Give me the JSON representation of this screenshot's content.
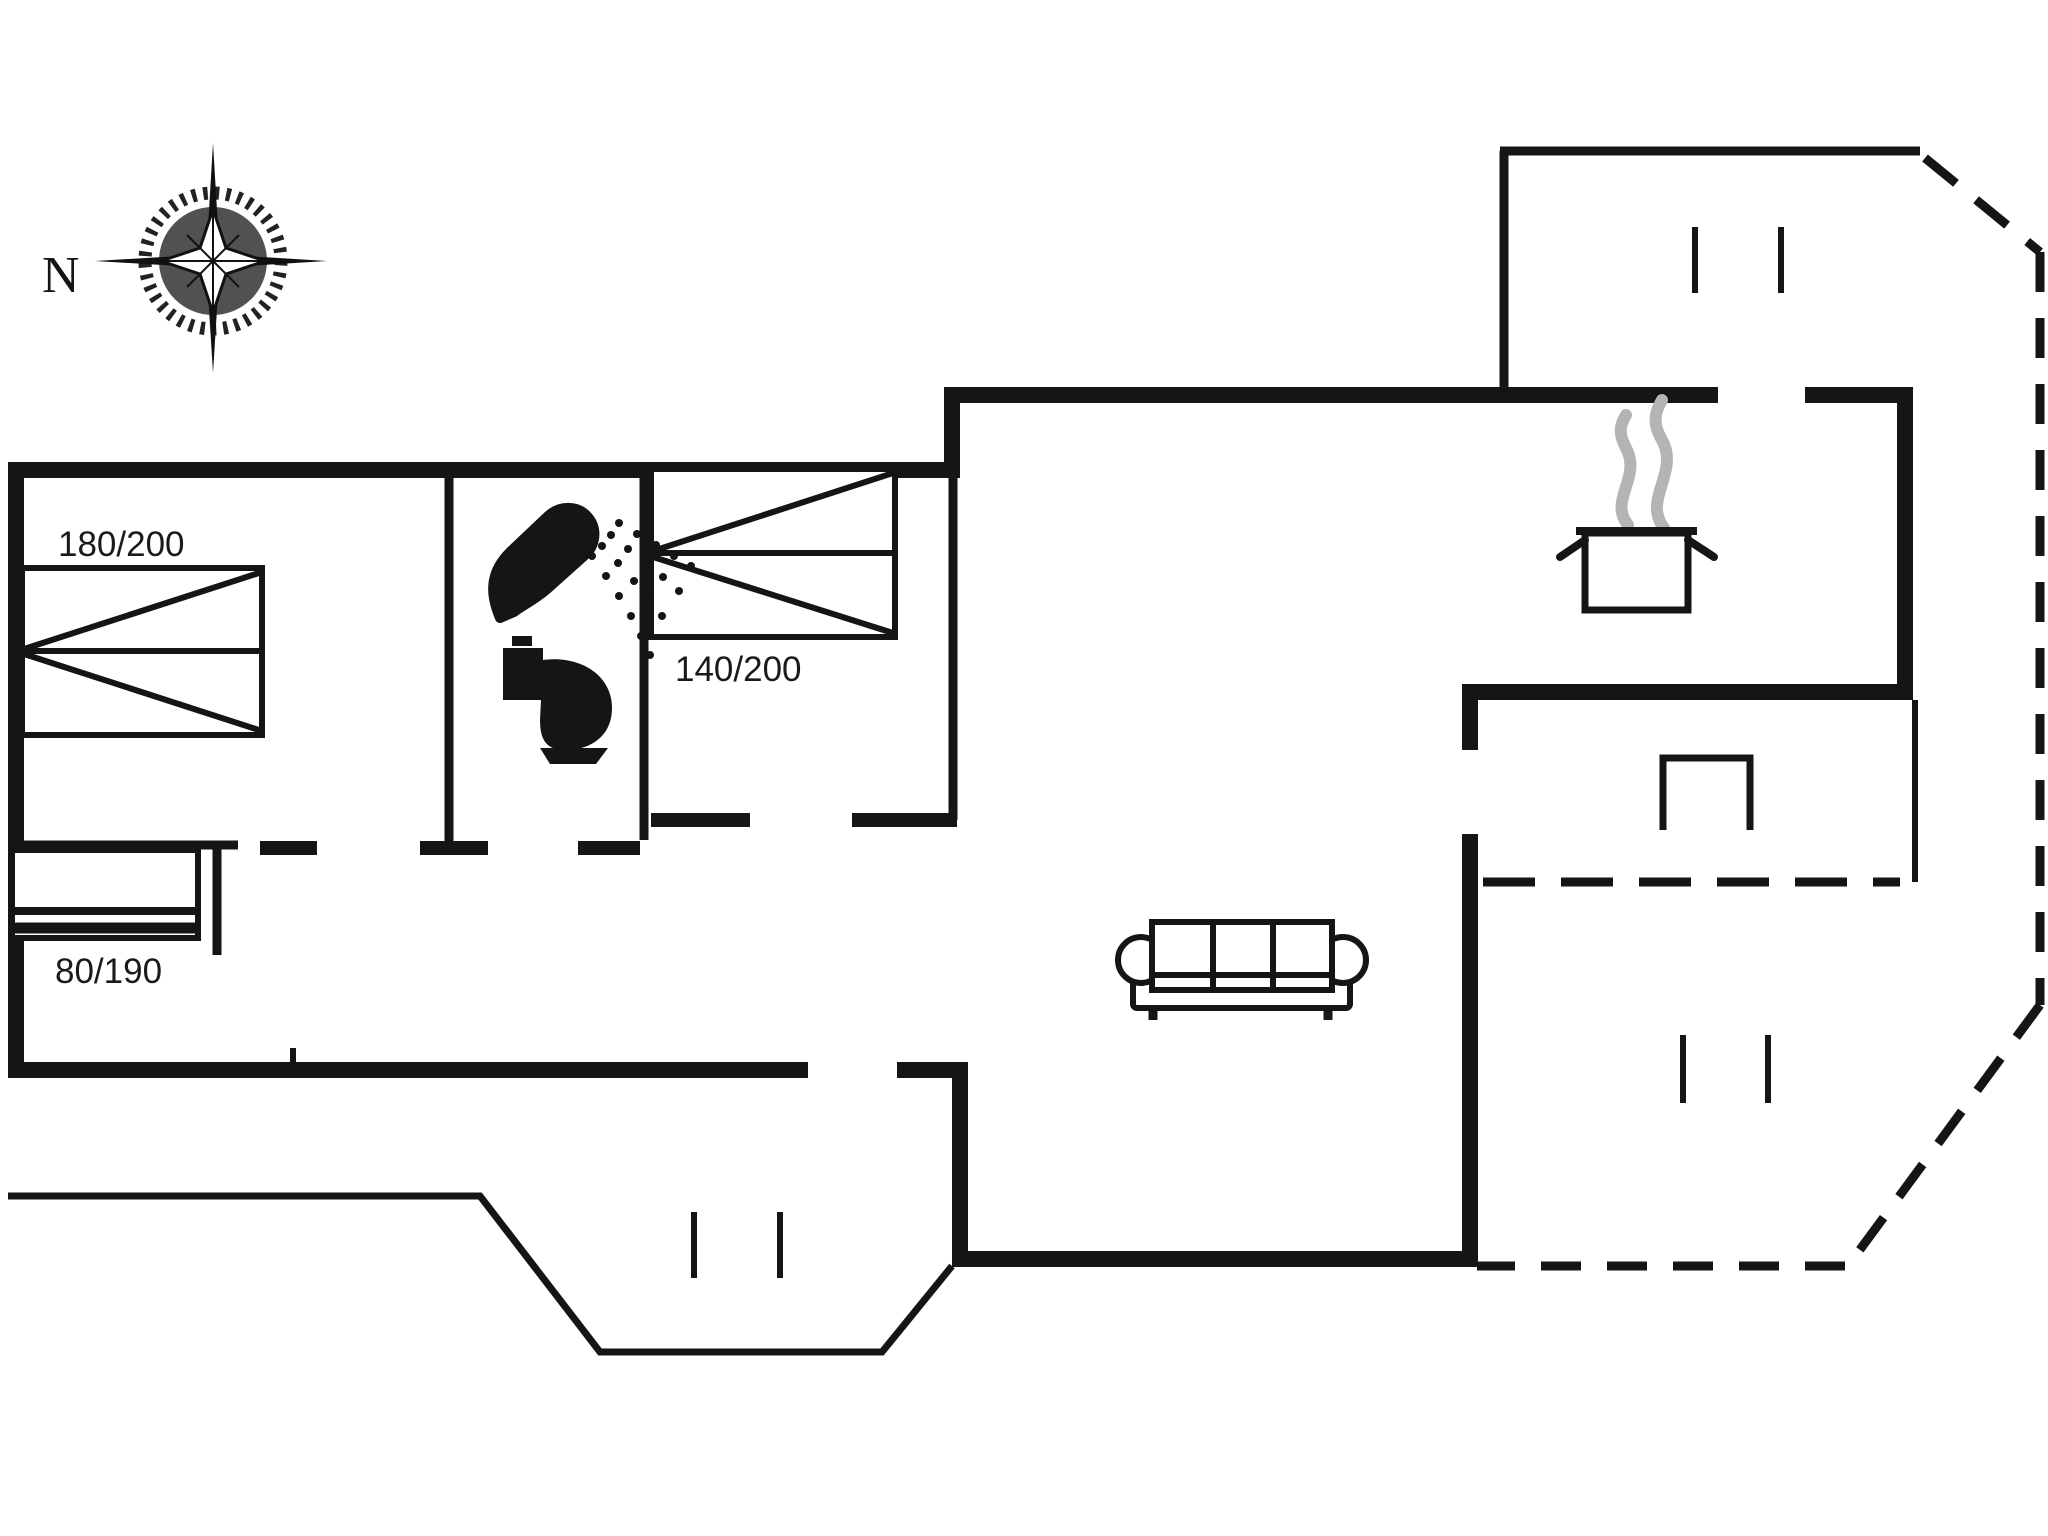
{
  "page": {
    "type": "floor-plan",
    "background_color": "#ffffff",
    "line_color": "#151515",
    "steam_color": "#b4b4b4",
    "compass_disc_color": "#515151"
  },
  "compass": {
    "label": "N",
    "icon": "compass-rose-icon"
  },
  "beds": [
    {
      "id": "double-bed-large",
      "label": "180/200",
      "room": "bedroom-left"
    },
    {
      "id": "double-bed-medium",
      "label": "140/200",
      "room": "bedroom-middle"
    },
    {
      "id": "single-bed",
      "label": "80/190",
      "room": "bedroom-small"
    }
  ],
  "fixtures": [
    {
      "name": "shower-icon",
      "room": "bathroom"
    },
    {
      "name": "toilet-icon",
      "room": "bathroom"
    },
    {
      "name": "cooking-pot-icon",
      "room": "kitchen"
    },
    {
      "name": "steam-icon",
      "room": "kitchen"
    },
    {
      "name": "fireplace-icon",
      "room": "living-room"
    },
    {
      "name": "sofa-icon",
      "room": "living-room"
    }
  ],
  "window_marks": {
    "top_right_pair": 2,
    "bottom_right_pair": 2,
    "terrace_pair": 2
  }
}
